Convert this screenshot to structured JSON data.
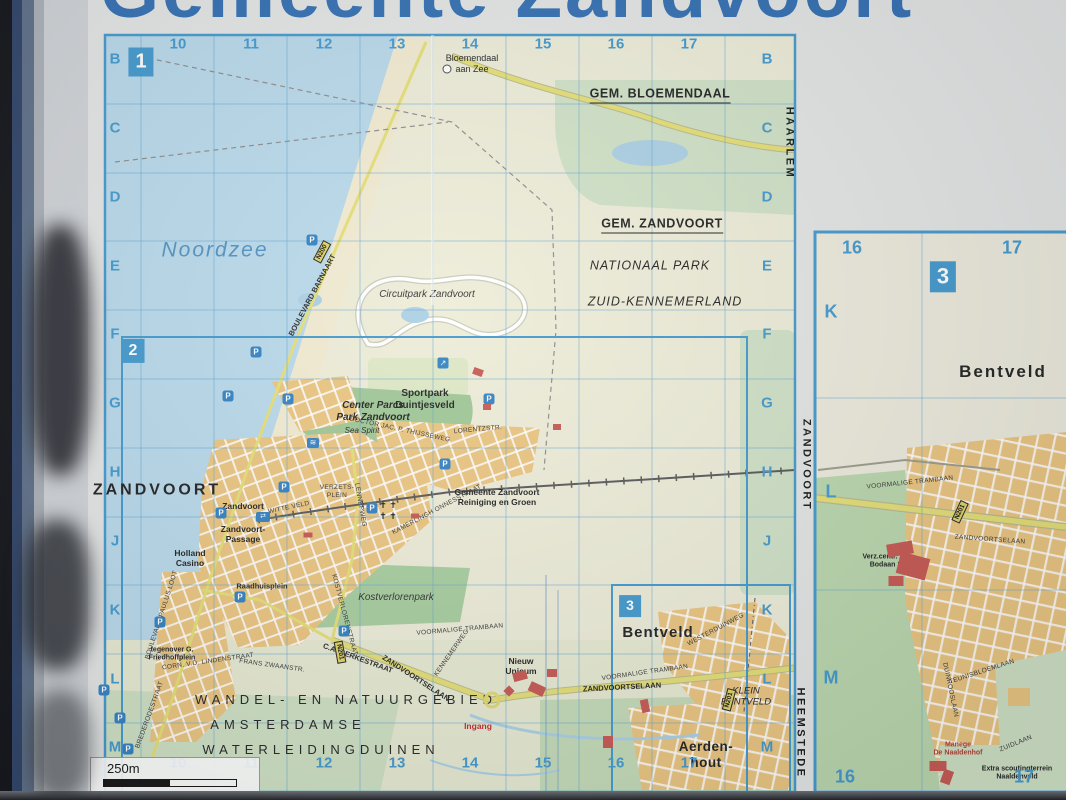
{
  "title": {
    "text": "Gemeente Zandvoort"
  },
  "grid": {
    "columns": [
      "10",
      "11",
      "12",
      "13",
      "14",
      "15",
      "16",
      "17"
    ],
    "rows": [
      "B",
      "C",
      "D",
      "E",
      "F",
      "G",
      "H",
      "J",
      "K",
      "L",
      "M"
    ]
  },
  "panel_grid": {
    "columns": [
      "16",
      "17"
    ],
    "rows": [
      "K",
      "L",
      "M"
    ]
  },
  "inset_markers": [
    {
      "id": "1",
      "x": 141,
      "y": 62,
      "fs": 20
    },
    {
      "id": "2",
      "x": 133,
      "y": 351,
      "fs": 16
    },
    {
      "id": "3",
      "x": 630,
      "y": 606,
      "fs": 14
    },
    {
      "id": "3",
      "x": 943,
      "y": 277,
      "fs": 22
    }
  ],
  "scale": {
    "label": "250m"
  },
  "icons": {
    "parking_glyph": "P",
    "station_glyph": "⇄",
    "pool_glyph": "≋",
    "viewpoint_glyph": "↗"
  },
  "colors": {
    "sea": "#b7d8e9",
    "sand": "#f1ead0",
    "land": "#edecd7",
    "forest": "#cfe1c5",
    "park_green": "#9dc694",
    "town": "#eac47d",
    "main_road": "#e4de72",
    "grid_line": "#5aa0d2",
    "marker_blue": "#3f97cc",
    "title_blue": "#2e6cb0",
    "building_red": "#c6554f"
  },
  "map_labels": [
    {
      "n": "label-gem-bloemendaal",
      "t": "GEM. BLOEMENDAAL",
      "x": 660,
      "y": 95,
      "c": "muni"
    },
    {
      "n": "label-bloemendaal-aan-zee",
      "t": "Bloemendaal\naan Zee",
      "x": 472,
      "y": 64,
      "c": "poi10"
    },
    {
      "n": "label-gem-zandvoort",
      "t": "GEM. ZANDVOORT",
      "x": 662,
      "y": 225,
      "c": "muni"
    },
    {
      "n": "label-nationaal-park",
      "t": "NATIONAAL PARK",
      "x": 650,
      "y": 266,
      "c": "np"
    },
    {
      "n": "label-zuid-kennemerland",
      "t": "ZUID-KENNEMERLAND",
      "x": 665,
      "y": 302,
      "c": "np"
    },
    {
      "n": "label-noordzee",
      "t": "Noordzee",
      "x": 215,
      "y": 250,
      "c": "sea"
    },
    {
      "n": "label-circuitpark",
      "t": "Circuitpark Zandvoort",
      "x": 427,
      "y": 295,
      "c": "park"
    },
    {
      "n": "label-sportpark",
      "t": "Sportpark\nDuintjesveld",
      "x": 425,
      "y": 400,
      "c": "poi11"
    },
    {
      "n": "label-center-parcs",
      "t": "Center Parcs\nPark Zandvoort",
      "x": 373,
      "y": 412,
      "c": "park-b"
    },
    {
      "n": "label-sea-spirit",
      "t": "Sea Spirit",
      "x": 362,
      "y": 431,
      "c": "park-s"
    },
    {
      "n": "label-zandvoort-town",
      "t": "ZANDVOORT",
      "x": 157,
      "y": 490,
      "c": "town-xl"
    },
    {
      "n": "label-station-zandvoort",
      "t": "Zandvoort",
      "x": 243,
      "y": 506,
      "c": "poi9"
    },
    {
      "n": "label-witte-veld",
      "t": "WITTE VELD",
      "x": 289,
      "y": 508,
      "c": "street",
      "r": -12
    },
    {
      "n": "label-zandvoort-passage",
      "t": "Zandvoort-\nPassage",
      "x": 243,
      "y": 534,
      "c": "poi9"
    },
    {
      "n": "label-holland-casino",
      "t": "Holland\nCasino",
      "x": 190,
      "y": 558,
      "c": "poi9"
    },
    {
      "n": "label-verzetsplein",
      "t": "VERZETS-\nPLEIN",
      "x": 337,
      "y": 492,
      "c": "street"
    },
    {
      "n": "label-lennepweg",
      "t": "LENNEPWEG",
      "x": 360,
      "y": 505,
      "c": "street",
      "r": 80
    },
    {
      "n": "label-raadhuisplein",
      "t": "Raadhuisplein",
      "x": 262,
      "y": 586,
      "c": "street8"
    },
    {
      "n": "label-kostverlorenpark",
      "t": "Kostverlorenpark",
      "x": 396,
      "y": 598,
      "c": "park"
    },
    {
      "n": "label-kostverlorenstraat",
      "t": "KOSTVERLORENSTRAAT",
      "x": 344,
      "y": 615,
      "c": "street",
      "r": 75
    },
    {
      "n": "label-gemeente-reiniging",
      "t": "Gemeente Zandvoort\nReiniging en Groen",
      "x": 497,
      "y": 497,
      "c": "poi9"
    },
    {
      "n": "label-kamerlingh-onnesstraat",
      "t": "KAMERLINGH ONNESSTRAAT",
      "x": 437,
      "y": 510,
      "c": "street",
      "r": -28
    },
    {
      "n": "label-lorentzstr",
      "t": "LORENTZSTR.",
      "x": 478,
      "y": 430,
      "c": "street",
      "r": -5
    },
    {
      "n": "label-thijsseweg",
      "t": "DOCTOR JAC. P. THIJSSEWEG",
      "x": 400,
      "y": 430,
      "c": "street",
      "r": 12
    },
    {
      "n": "label-boulevard-barnaart",
      "t": "BOULEVARD BARNAART",
      "x": 312,
      "y": 295,
      "c": "street8",
      "r": -62
    },
    {
      "n": "label-boulevard-paulus-loot",
      "t": "BOULEVARD PAULUS LOOT",
      "x": 162,
      "y": 615,
      "c": "street",
      "r": -72
    },
    {
      "n": "label-brederodestraat",
      "t": "BREDERODESTRAAT",
      "x": 150,
      "y": 715,
      "c": "street",
      "r": -70
    },
    {
      "n": "label-corn-lindenstraat",
      "t": "CORN. V.D. LINDENSTRAAT",
      "x": 208,
      "y": 662,
      "c": "street",
      "r": -8
    },
    {
      "n": "label-frans-zwaanstr",
      "t": "FRANS ZWAANSTR.",
      "x": 272,
      "y": 666,
      "c": "street",
      "r": 8
    },
    {
      "n": "label-gerkestraat",
      "t": "C.A. GERKESTRAAT",
      "x": 358,
      "y": 658,
      "c": "street8",
      "r": 20
    },
    {
      "n": "label-zandvoortselaan-w",
      "t": "ZANDVOORTSELAAN",
      "x": 416,
      "y": 678,
      "c": "street8",
      "r": 33
    },
    {
      "n": "label-zandvoortselaan-e",
      "t": "ZANDVOORTSELAAN",
      "x": 622,
      "y": 687,
      "c": "street8",
      "r": -3
    },
    {
      "n": "label-kennemerweg",
      "t": "KENNEMERWEG",
      "x": 452,
      "y": 653,
      "c": "street",
      "r": -55
    },
    {
      "n": "label-voormalige-trambaan-1",
      "t": "VOORMALIGE TRAMBAAN",
      "x": 460,
      "y": 630,
      "c": "street",
      "r": -5
    },
    {
      "n": "label-voormalige-trambaan-2",
      "t": "VOORMALIGE TRAMBAAN",
      "x": 645,
      "y": 673,
      "c": "street",
      "r": -8
    },
    {
      "n": "label-westerduinweg",
      "t": "WESTERDUINWEG",
      "x": 716,
      "y": 630,
      "c": "street",
      "r": -28
    },
    {
      "n": "label-nieuw-unicum",
      "t": "Nieuw\nUnicum",
      "x": 521,
      "y": 666,
      "c": "poi9"
    },
    {
      "n": "label-ingang",
      "t": "Ingang",
      "x": 478,
      "y": 726,
      "c": "poi-red"
    },
    {
      "n": "label-wandel-natuurgebied",
      "t": "WANDEL- EN NATUURGEBIED",
      "x": 346,
      "y": 700,
      "c": "nature"
    },
    {
      "n": "label-amsterdamse",
      "t": "AMSTERDAMSE",
      "x": 288,
      "y": 725,
      "c": "nature"
    },
    {
      "n": "label-waterleidingduinen",
      "t": "WATERLEIDINGDUINEN",
      "x": 321,
      "y": 750,
      "c": "nature"
    },
    {
      "n": "label-bentveld-main",
      "t": "Bentveld",
      "x": 658,
      "y": 633,
      "c": "town-lg"
    },
    {
      "n": "label-klein-bentveld",
      "t": "KLEIN\nBENTVELD",
      "x": 746,
      "y": 697,
      "c": "small-place"
    },
    {
      "n": "label-aerdenhout",
      "t": "Aerden-\nhout",
      "x": 706,
      "y": 755,
      "c": "town-md"
    },
    {
      "n": "label-haarlem-edge",
      "t": "HAARLEM",
      "x": 789,
      "y": 143,
      "c": "edge-v",
      "r": 90
    },
    {
      "n": "label-heemstede-edge",
      "t": "HEEMSTEDE",
      "x": 800,
      "y": 733,
      "c": "edge-v",
      "r": 90
    },
    {
      "n": "label-friedhoffplein",
      "t": "tegenover G.\nFriedhoffplein",
      "x": 172,
      "y": 655,
      "c": "poi8"
    },
    {
      "n": "label-churches",
      "t": "✝ ✝\n✝ ✝",
      "x": 388,
      "y": 511,
      "c": "cross"
    },
    {
      "n": "label-bentveld-panel",
      "t": "Bentveld",
      "x": 1003,
      "y": 372,
      "c": "town-xl2"
    },
    {
      "n": "label-zandvoort-panel-edge",
      "t": "ZANDVOORT",
      "x": 806,
      "y": 465,
      "c": "edge-v",
      "r": 90
    },
    {
      "n": "label-voormalige-trambaan-panel",
      "t": "VOORMALIGE TRAMBAAN",
      "x": 910,
      "y": 483,
      "c": "street",
      "r": -6
    },
    {
      "n": "label-zandvoortselaan-panel",
      "t": "ZANDVOORTSELAAN",
      "x": 990,
      "y": 540,
      "c": "street",
      "r": 4
    },
    {
      "n": "label-bodaan",
      "t": "Verz.centr. A.G.\nBodaan St.",
      "x": 888,
      "y": 562,
      "c": "poi8"
    },
    {
      "n": "label-teunisbloemlaan",
      "t": "TEUNISBLOEMLAAN",
      "x": 982,
      "y": 672,
      "c": "street",
      "r": -18
    },
    {
      "n": "label-duinrooslaan",
      "t": "DUINROOSLAAN",
      "x": 950,
      "y": 690,
      "c": "street",
      "r": 78
    },
    {
      "n": "label-zuidlaan",
      "t": "ZUIDLAAN",
      "x": 1016,
      "y": 744,
      "c": "street",
      "r": -22
    },
    {
      "n": "label-manege-naaldenhof",
      "t": "Manege\nDe Naaldenhof",
      "x": 958,
      "y": 750,
      "c": "poi-red8"
    },
    {
      "n": "label-naaldenveld",
      "t": "Extra scoutingterrein\nNaaldenveld",
      "x": 1017,
      "y": 774,
      "c": "poi8"
    }
  ],
  "road_badges": [
    {
      "t": "N200",
      "x": 322,
      "y": 252,
      "r": -62
    },
    {
      "t": "N201",
      "x": 340,
      "y": 652,
      "r": 80
    },
    {
      "t": "N201",
      "x": 729,
      "y": 700,
      "r": -75
    },
    {
      "t": "N201",
      "x": 960,
      "y": 512,
      "r": -65
    }
  ],
  "parking_icons": [
    [
      312,
      240
    ],
    [
      256,
      352
    ],
    [
      228,
      396
    ],
    [
      288,
      399
    ],
    [
      489,
      399
    ],
    [
      445,
      464
    ],
    [
      372,
      508
    ],
    [
      221,
      513
    ],
    [
      284,
      487
    ],
    [
      160,
      622
    ],
    [
      240,
      597
    ],
    [
      344,
      631
    ],
    [
      120,
      718
    ],
    [
      128,
      749
    ],
    [
      104,
      690
    ]
  ],
  "poi_icons": [
    {
      "n": "station-icon",
      "x": 263,
      "y": 517,
      "g": "station_glyph",
      "w": 14,
      "h": 10,
      "fs": 7
    },
    {
      "n": "pool-icon",
      "x": 313,
      "y": 443,
      "g": "pool_glyph",
      "w": 12,
      "h": 10,
      "fs": 8
    },
    {
      "n": "viewpoint-icon",
      "x": 443,
      "y": 363,
      "g": "viewpoint_glyph",
      "w": 11,
      "h": 11,
      "fs": 8
    }
  ],
  "red_buildings": [
    [
      478,
      372,
      10,
      7,
      20
    ],
    [
      487,
      407,
      8,
      6,
      0
    ],
    [
      308,
      535,
      9,
      5,
      0
    ],
    [
      557,
      427,
      8,
      6,
      0
    ],
    [
      415,
      516,
      8,
      5,
      0
    ],
    [
      520,
      676,
      14,
      9,
      -15
    ],
    [
      537,
      689,
      16,
      10,
      25
    ],
    [
      552,
      673,
      10,
      8,
      0
    ],
    [
      509,
      691,
      8,
      8,
      45
    ],
    [
      608,
      742,
      10,
      12,
      0
    ],
    [
      645,
      706,
      8,
      13,
      -12
    ],
    [
      900,
      549,
      26,
      13,
      -10
    ],
    [
      913,
      566,
      30,
      22,
      15
    ],
    [
      896,
      581,
      15,
      10,
      0
    ],
    [
      938,
      766,
      17,
      10,
      0
    ],
    [
      947,
      777,
      10,
      14,
      20
    ]
  ]
}
